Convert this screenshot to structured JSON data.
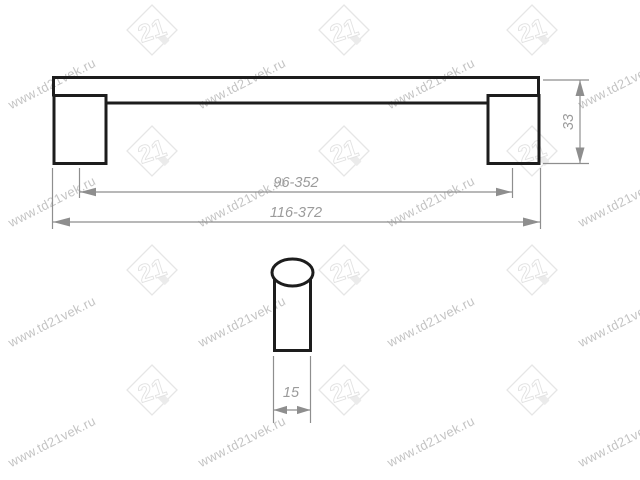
{
  "page": {
    "background": "#ffffff"
  },
  "watermark": {
    "text": "www.td21vek.ru",
    "logo_number": "21",
    "text_color": "#c4c4c4",
    "logo_color": "#e6e6e6"
  },
  "drawing": {
    "type": "technical-drawing",
    "subject": "furniture-handle-two-views",
    "line_color": "#1d1d1d",
    "dim_line_color": "#8e8e8e",
    "dim_text_color": "#9b9b9b",
    "dimensions": {
      "hole_spacing_mm": "96-352",
      "overall_length_mm": "116-372",
      "height_mm": "33",
      "diameter_mm": "15"
    }
  }
}
